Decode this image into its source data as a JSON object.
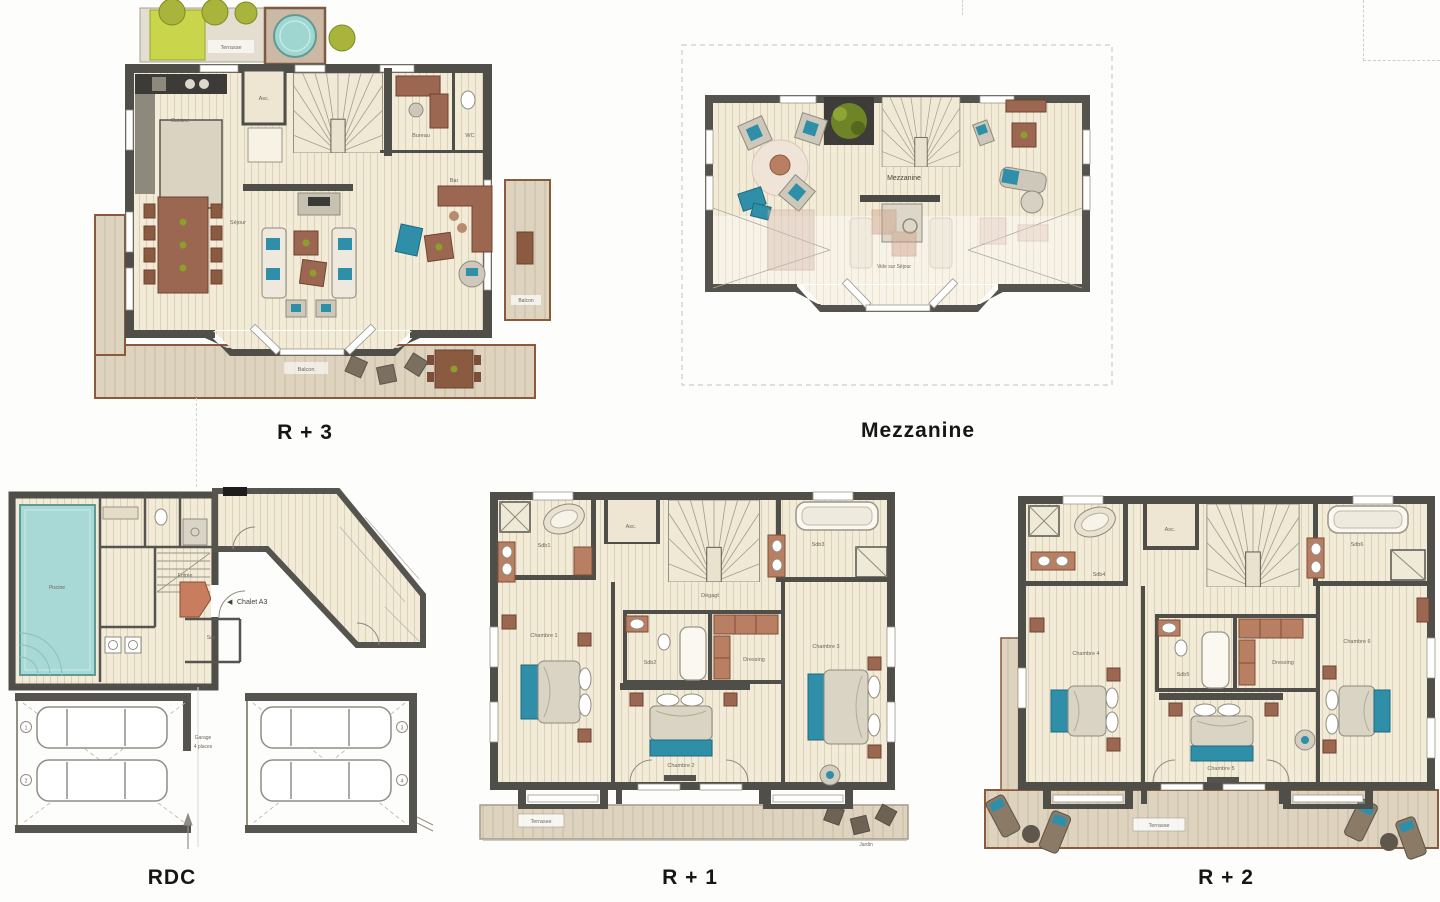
{
  "document": {
    "type": "chalet-floor-plans",
    "sheet_background": "#fdfdfc"
  },
  "colors": {
    "wall": "#504e49",
    "wall_light": "#94907f",
    "floor": "#f2ebd8",
    "wood_deck": "#d3c5ac",
    "deck_rim": "#8a5a3c",
    "pool": "#a9d9d6",
    "bed_teal": "#2f8fa8",
    "furniture_brown": "#9c6750",
    "cabinet_brown": "#b97f63",
    "plant_olive": "#8f9c2e",
    "title_color": "#161616"
  },
  "plans": {
    "r3": {
      "title": "R + 3",
      "labels": {
        "terrasse": "Terrasse",
        "cuisine": "Cuisine",
        "asc": "Asc.",
        "bureau": "Bureau",
        "wc": "WC",
        "bar": "Bar",
        "sejour": "Séjour",
        "balcon": "Balcon",
        "balcon_side": "Balcon"
      }
    },
    "mezzanine": {
      "title": "Mezzanine",
      "labels": {
        "room": "Mezzanine",
        "vide": "Vide sur Séjour"
      }
    },
    "rdc": {
      "title": "RDC",
      "labels": {
        "piscine": "Piscine",
        "entree": "Entrée",
        "arrow": "◀",
        "chalet": "Chalet A3",
        "sas": "Sas",
        "garage_l1": "Garage",
        "garage_l2": "4 places",
        "n1": "1",
        "n2": "2",
        "n3": "3",
        "n4": "4"
      }
    },
    "r1": {
      "title": "R + 1",
      "labels": {
        "sdb1": "Sdb1",
        "asc": "Asc.",
        "sdb3": "Sdb3",
        "degagt": "Dégagt",
        "chambre1": "Chambre 1",
        "sdb2": "Sdb2",
        "dressing": "Dressing",
        "chambre3": "Chambre 3",
        "chambre2": "Chambre 2",
        "terrasse": "Terrasse",
        "jardin": "Jardin"
      }
    },
    "r2": {
      "title": "R + 2",
      "labels": {
        "sdb4": "Sdb4",
        "asc": "Asc.",
        "sdb6": "Sdb6",
        "chambre4": "Chambre 4",
        "sdb5": "Sdb5",
        "dressing": "Dressing",
        "chambre6": "Chambre 6",
        "chambre5": "Chambre 5",
        "terrasse": "Terrasse"
      }
    }
  }
}
